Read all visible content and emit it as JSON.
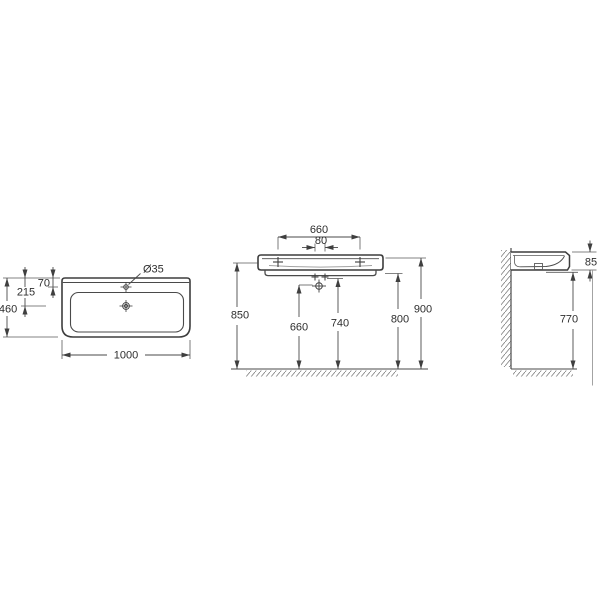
{
  "colors": {
    "background": "#ffffff",
    "object_line": "#3d3d3d",
    "dimension_line": "#4a4a4a",
    "text": "#2e2e2e",
    "hatch": "#808080"
  },
  "top_view": {
    "overall_width": "1000",
    "overall_depth": "460",
    "drain_offset": "215",
    "tap_hole_offset": "70",
    "tap_hole_diameter": "Ø35"
  },
  "front_view": {
    "fixing_centers": "660",
    "bolt_spacing": "80",
    "height_fixing": "850",
    "height_trap": "660",
    "height_bolts": "740",
    "height_underside": "800",
    "height_rim": "900"
  },
  "side_view": {
    "rim_thickness": "85",
    "height_clearance": "770"
  }
}
